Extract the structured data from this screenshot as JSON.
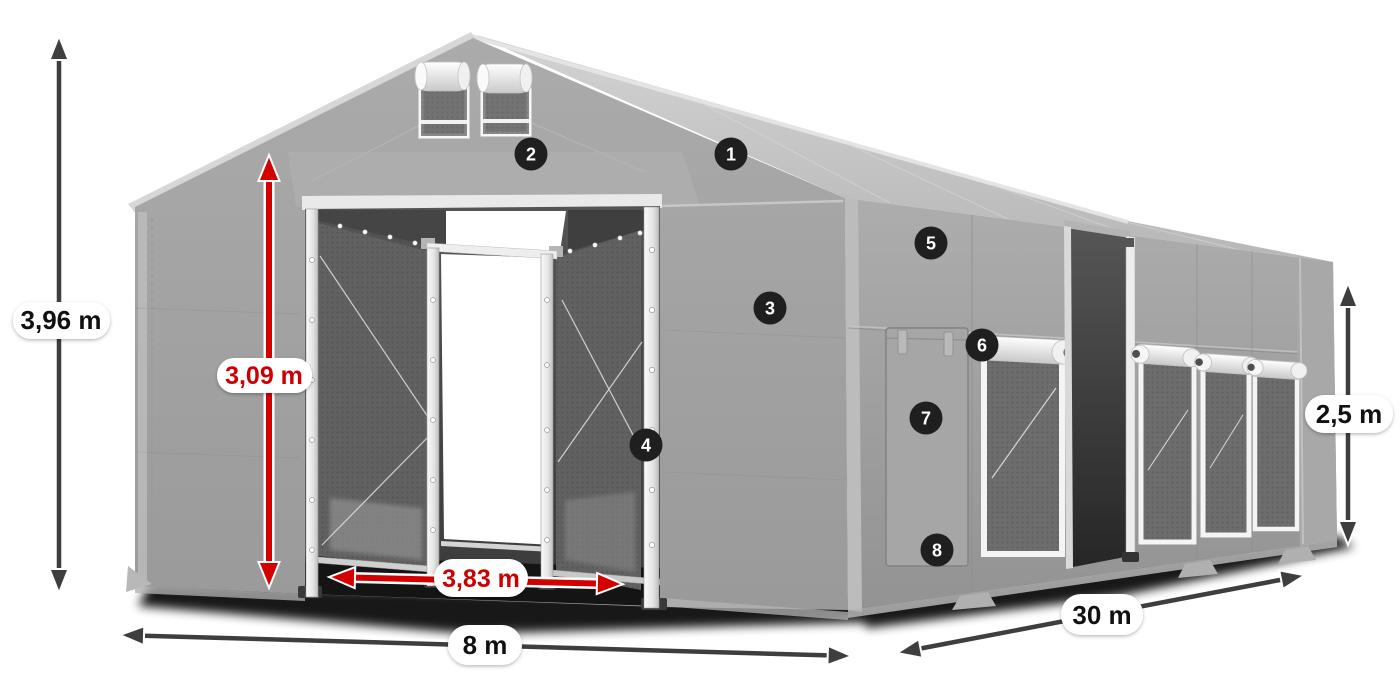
{
  "product_illustration": {
    "subject": "storage-tent-with-dimension-callouts",
    "background": "#ffffff"
  },
  "dimensions": {
    "total_height": "3,96 m",
    "door_height": "3,09 m",
    "door_width": "3,83 m",
    "tent_width": "8 m",
    "tent_length": "30 m",
    "side_height": "2,5 m"
  },
  "feature_badges": [
    "1",
    "2",
    "3",
    "4",
    "5",
    "6",
    "7",
    "8"
  ],
  "colors": {
    "tent_gray": "#a3a3a3",
    "roof_gray": "#c6c6c6",
    "eave_white": "#e6e6e6",
    "interior_dark": "#474747",
    "dimension_arrow": "#3e3e3e",
    "dimension_red": "#d40000",
    "badge_background": "#1f1f1f",
    "badge_text": "#ffffff",
    "label_pill": "#ffffff",
    "label_text_dark": "#111111",
    "label_text_red": "#cc0000"
  }
}
